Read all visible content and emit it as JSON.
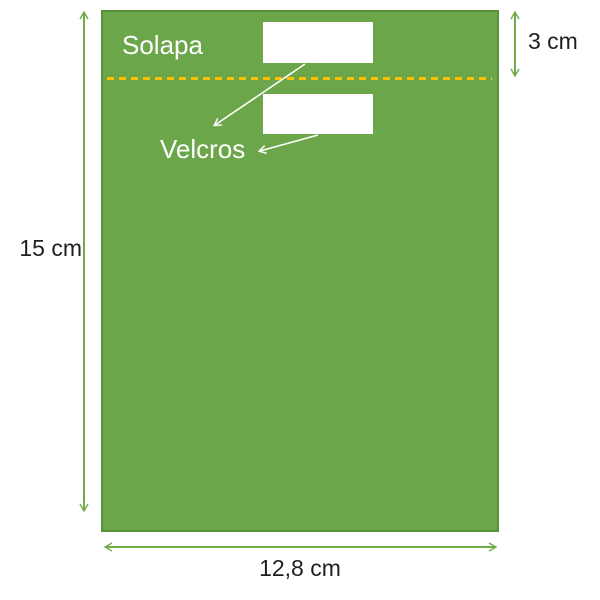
{
  "diagram": {
    "title": "bag-sewing-pattern",
    "annotations": {
      "flap_label": "Solapa",
      "velcros_label": "Velcros"
    },
    "dimensions": {
      "height": "15 cm",
      "flap_height": "3 cm",
      "width": "12,8 cm"
    }
  },
  "colors": {
    "bag_fill": "#6CA64A",
    "bag_border": "#57923B",
    "fold_line": "#FFC000",
    "dimension_arrow": "#70AD47",
    "annotation_arrow": "#FFFFFF",
    "dimension_text": "#1F1F1F",
    "label_text": "#FFFFFF"
  }
}
